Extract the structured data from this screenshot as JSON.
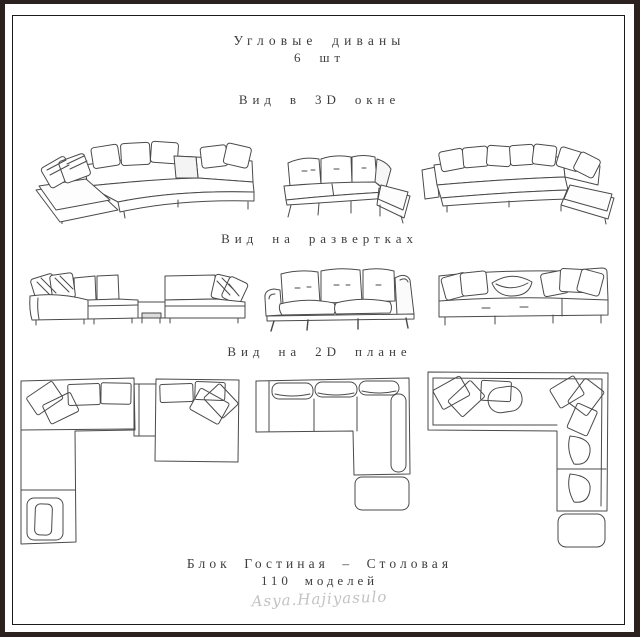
{
  "header": {
    "title": "Угловые диваны",
    "count": "6 шт"
  },
  "sections": {
    "view3d": "Вид в 3D окне",
    "unfolds": "Вид на развертках",
    "plan2d": "Вид на 2D плане"
  },
  "footer": {
    "block": "Блок Гостиная – Столовая",
    "models": "110 моделей",
    "signature": "Asya.Hajiyasulo"
  },
  "colors": {
    "frame": "#2b2220",
    "ink": "#4a4a4a",
    "text": "#3d3d3d",
    "signature": "#c3c3c3"
  }
}
